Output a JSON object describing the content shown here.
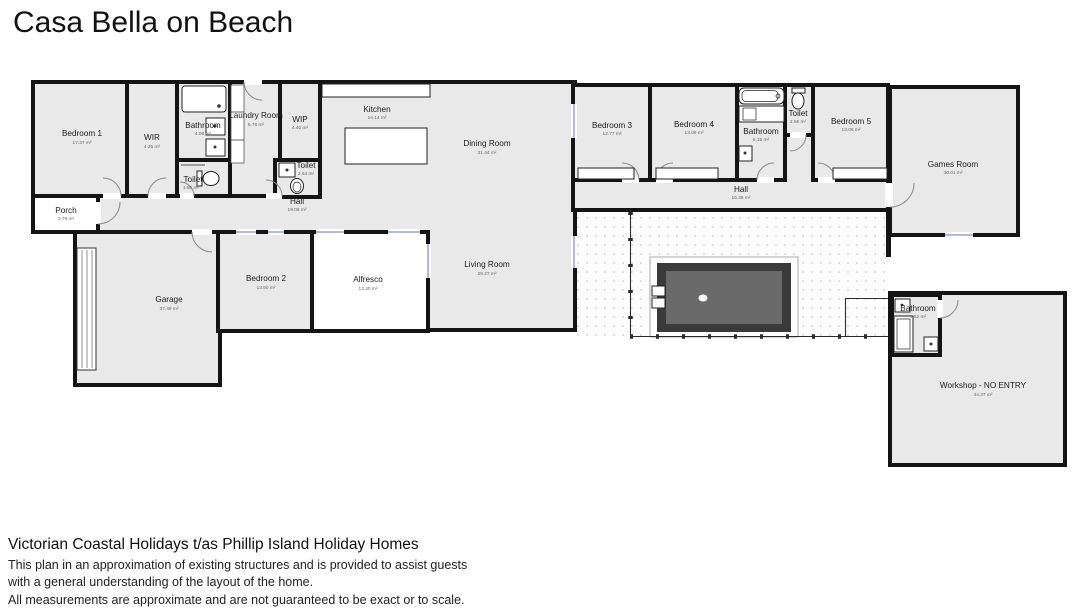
{
  "title": "Casa Bella on Beach",
  "plan": {
    "rooms": {
      "bedroom1": {
        "name": "Bedroom 1",
        "area": "17.37 m²"
      },
      "wir": {
        "name": "WIR",
        "area": "4.25 m²"
      },
      "bathroom_main": {
        "name": "Bathroom",
        "area": "4.08 m²"
      },
      "toilet_main": {
        "name": "Toilet",
        "area": "1.80 m²"
      },
      "laundry": {
        "name": "Laundry Room",
        "area": "5.76 m²"
      },
      "wip": {
        "name": "WIP",
        "area": "4.40 m²"
      },
      "toilet_hall": {
        "name": "Toilet",
        "area": "2.64 m²"
      },
      "hall_left": {
        "name": "Hall",
        "area": "19.06 m²"
      },
      "kitchen": {
        "name": "Kitchen",
        "area": "14.14 m²"
      },
      "dining": {
        "name": "Dining Room",
        "area": "31.44 m²"
      },
      "living": {
        "name": "Living Room",
        "area": "29.27 m²"
      },
      "porch": {
        "name": "Porch",
        "area": "3.79 m²"
      },
      "garage": {
        "name": "Garage",
        "area": "37.49 m²"
      },
      "bedroom2": {
        "name": "Bedroom 2",
        "area": "13.50 m²"
      },
      "alfresco": {
        "name": "Alfresco",
        "area": "13.40 m²"
      },
      "bedroom3": {
        "name": "Bedroom 3",
        "area": "12.77 m²"
      },
      "bedroom4": {
        "name": "Bedroom 4",
        "area": "13.06 m²"
      },
      "bathroom_guest": {
        "name": "Bathroom",
        "area": "6.15 m²"
      },
      "toilet_guest": {
        "name": "Toilet",
        "area": "2.56 m²"
      },
      "bedroom5": {
        "name": "Bedroom 5",
        "area": "13.06 m²"
      },
      "hall_right": {
        "name": "Hall",
        "area": "16.35 m²"
      },
      "games": {
        "name": "Games Room",
        "area": "30.01 m²"
      },
      "bathroom_workshop": {
        "name": "Bathroom",
        "area": "4.52 m²"
      },
      "workshop": {
        "name": "Workshop - NO ENTRY",
        "area": "44.37 m²"
      }
    },
    "colors": {
      "wall": "#141414",
      "room_fill": "#e9e9e9",
      "outdoor_fill": "#ffffff",
      "pool_rim": "#3a3a3a",
      "pool_water": "#6a6a6a",
      "window_marker": "#9aa0d8"
    }
  },
  "footer": {
    "company": "Victorian Coastal Holidays t/as Phillip Island Holiday Homes",
    "disclaimer1": "This plan in an approximation of existing structures and is provided to assist guests",
    "disclaimer2": "with a general understanding of the layout of the home.",
    "disclaimer3": "All measurements are approximate and are not guaranteed to be exact or to scale."
  }
}
